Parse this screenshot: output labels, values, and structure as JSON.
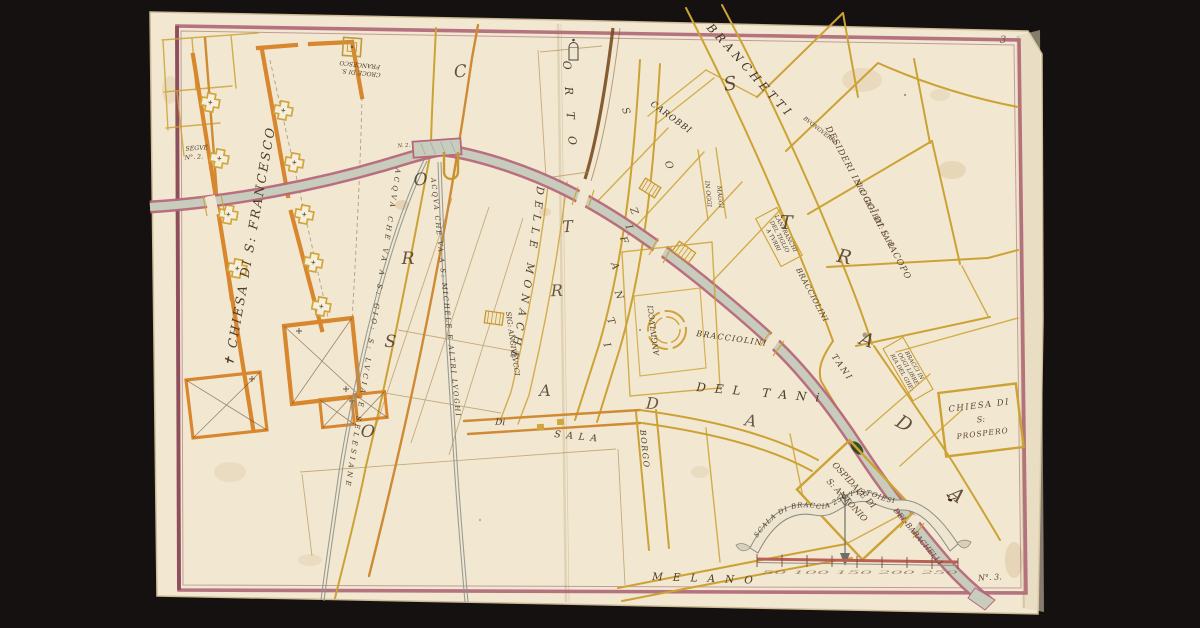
{
  "map_title": "Manuscript city plan with canal (gora), braccia pistoiesi scale",
  "page_number": "3",
  "colors": {
    "background": "#141110",
    "paper": "#f2e8d2",
    "border_pink": "#ad6674",
    "road_yellow": "#cda235",
    "wall_orange": "#d8872e",
    "road_brown": "#7a4e20",
    "canal_gray": "#c7ccbd",
    "canal_pink": "#b5687a",
    "water_line": "#8f948b",
    "ink": "#4f3d2a",
    "green_mark": "#2c4215"
  },
  "labels": {
    "segue_1": "SEGVE",
    "segue_2": "N°. 2.",
    "n2": "N. 2.",
    "n3": "N°. 3.",
    "croce_1": "CROCE DI S.",
    "croce_2": "FRANCESCO",
    "chiesa_sf": "✝ CHIESA DI S: FRANCESCO",
    "orto": "ORTO",
    "carobbi": "CAROBBI",
    "branchetti": "BRANCHETTI",
    "bvongverri": "BVONGVERRI",
    "desideri": "DESIDERI IN OGGI DI S: IACOPO",
    "lari": "SIG: GIO: BAT: LARI",
    "tiglio": [
      "LANFRANCHI",
      "DEL TIGLIO",
      "A TVRRI"
    ],
    "bracci": [
      "BRACCI IN",
      "OGGI LIBRE",
      "RIA DEL GHE:"
    ],
    "bracciolini_a": "BRACCIOLINI",
    "bracciolini_b": "BRACCIOLINI",
    "tani": "TANI",
    "del_tani": "DEL TANi",
    "angivlvcci_a": "SIG: ANGIVLVCCI",
    "angivlvcci_b": "ANGIVLVCCI",
    "in_oggi": "IN OGGI",
    "maggi": "MAGGI",
    "delle_monache": "DELLE MONACHE",
    "acqua_gio": "ACQVA CHE VA A S: GIO: S: LVCIA E SELESIANE",
    "acqua_michele": "ACQVA CHE VA A S: MICHELE E ALTRI LVOGHI",
    "di": "Di",
    "sala": "SALA",
    "borgo": "BORGO",
    "melano": "MELANO",
    "ospidale_1": "OSPIDALE DI",
    "ospidale_2": "S: ANTONIO",
    "barachelli": "DEL BARACHELLI",
    "prospero_1": "CHIESA DI",
    "prospero_2": "S:",
    "prospero_3": "PROSPERO",
    "scala": "SCALA DI BRACCIA 250 PISTOIESI",
    "scale_ticks": "50 100 150 200 250"
  },
  "letters": {
    "corso": [
      "C",
      "O",
      "R",
      "S",
      "O"
    ],
    "strada": [
      "S",
      "T",
      "R",
      "A",
      "D",
      "A"
    ],
    "strada2": [
      "T",
      "R",
      "A",
      "D",
      "A"
    ],
    "soz": [
      "S",
      "O",
      "Z",
      "I",
      "F",
      "A",
      "N",
      "T",
      "I"
    ]
  }
}
